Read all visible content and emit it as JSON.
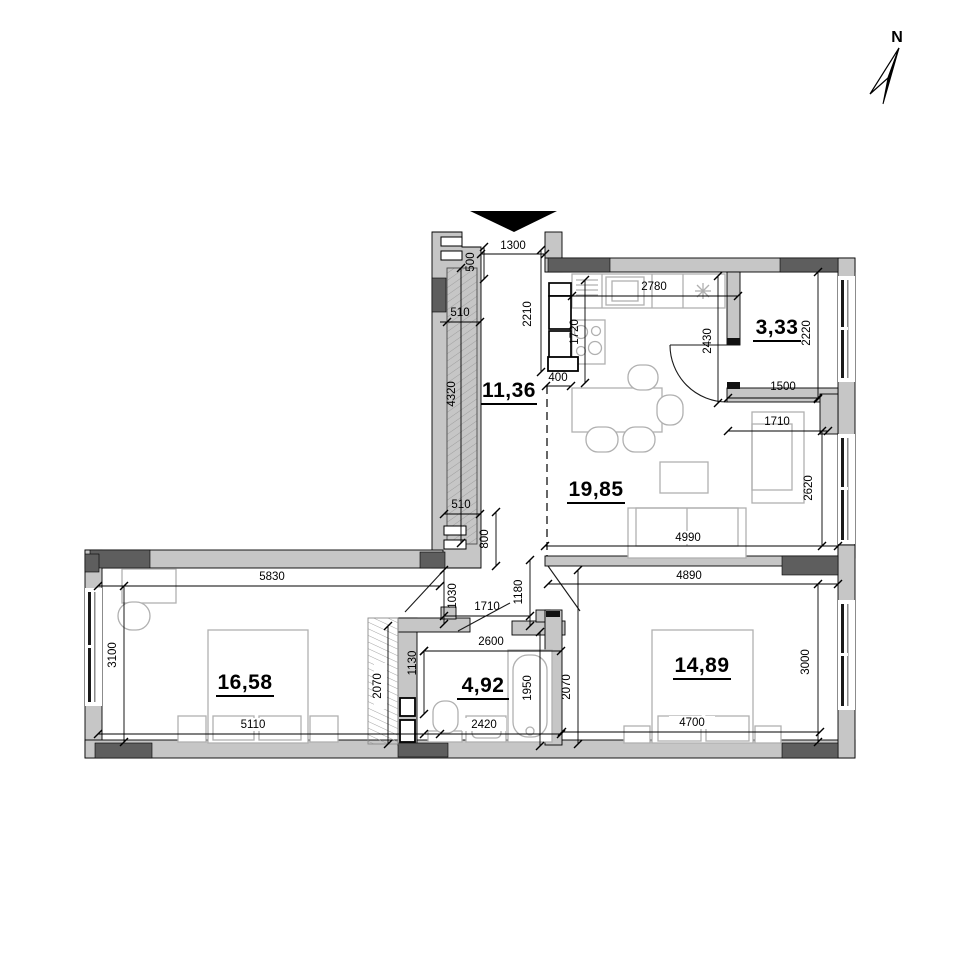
{
  "plan": {
    "compass_label": "N",
    "rooms": [
      {
        "name": "hallway",
        "area": "11,36"
      },
      {
        "name": "storage",
        "area": "3,33"
      },
      {
        "name": "living-kitchen",
        "area": "19,85"
      },
      {
        "name": "bedroom-1",
        "area": "16,58"
      },
      {
        "name": "bathroom",
        "area": "4,92"
      },
      {
        "name": "bedroom-2",
        "area": "14,89"
      }
    ],
    "dims": {
      "entry_width": "1300",
      "entry_depth": "500",
      "shaft_top": "510",
      "hall_right": "2210",
      "kitchen_col": "1720",
      "kitchen_width": "2780",
      "kitchen_door": "2430",
      "storage_right": "2220",
      "storage_width": "1500",
      "cabinet_depth": "400",
      "shaft_height": "4320",
      "shaft_bottom": "510",
      "hall_gap": "800",
      "bedroom1_door": "1030",
      "bedroom2_door": "1180",
      "doors_span": "1710",
      "armchair_width": "1710",
      "living_right": "2620",
      "sofa_wall": "4990",
      "bedroom2_top": "4890",
      "bedroom1_top": "5830",
      "bedroom1_left": "3100",
      "bedroom1_bottom": "5110",
      "bath_width": "2600",
      "bath_left": "1130",
      "tub_length": "1950",
      "bath_right": "2070",
      "closet_height": "2070",
      "basin_width": "2420",
      "bedroom2_right": "3000",
      "bedroom2_bottom": "4700"
    }
  }
}
